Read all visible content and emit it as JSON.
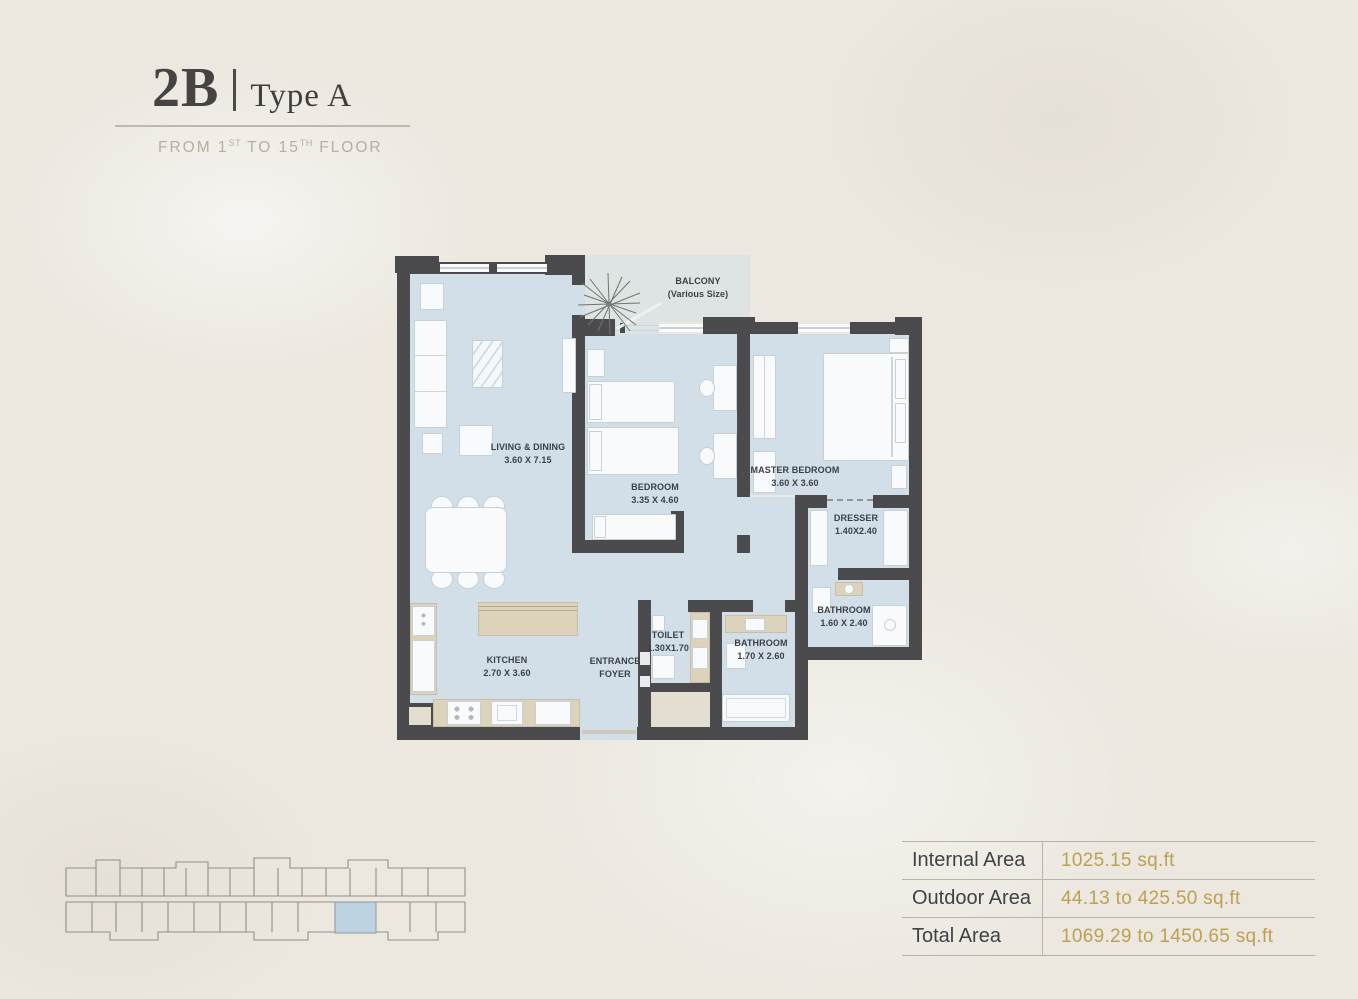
{
  "header": {
    "unit_code": "2B",
    "divider": "|",
    "unit_type": "Type A",
    "floor_range": {
      "part1": "FROM 1",
      "sup1": "ST",
      "part2": " TO 15",
      "sup2": "TH",
      "part3": " FLOOR"
    }
  },
  "plan": {
    "balcony": {
      "name": "BALCONY",
      "size_note": "(Various Size)"
    },
    "rooms": {
      "living": {
        "name": "LIVING & DINING",
        "dim": "3.60 X 7.15"
      },
      "bedroom": {
        "name": "BEDROOM",
        "dim": "3.35 X 4.60"
      },
      "master": {
        "name": "MASTER BEDROOM",
        "dim": "3.60 X 3.60"
      },
      "dresser": {
        "name": "DRESSER",
        "dim": "1.40X2.40"
      },
      "master_bath": {
        "name": "BATHROOM",
        "dim": "1.60 X 2.40"
      },
      "bathroom": {
        "name": "BATHROOM",
        "dim": "1.70 X 2.60"
      },
      "toilet": {
        "name": "TOILET",
        "dim": "1.30X1.70"
      },
      "foyer": {
        "name_line1": "ENTRANCE",
        "name_line2": "FOYER"
      },
      "kitchen": {
        "name": "KITCHEN",
        "dim": "2.70 X 3.60"
      }
    }
  },
  "area_table": {
    "rows": [
      {
        "label": "Internal Area",
        "value": "1025.15 sq.ft"
      },
      {
        "label": "Outdoor Area",
        "value": "44.13 to 425.50 sq.ft"
      },
      {
        "label": "Total Area",
        "value": "1069.29 to 1450.65 sq.ft"
      }
    ]
  },
  "colors": {
    "background": "#ece8e0",
    "wall": "#4b4b4d",
    "floor": "#d3dfe8",
    "balcony_floor": "#dee3e4",
    "counter_tan": "#ddd2ba",
    "accent_gold": "#bda052",
    "title_text": "#454442",
    "subtitle_text": "#b8ae9f",
    "keyplan_highlight": "#bed3e1"
  }
}
